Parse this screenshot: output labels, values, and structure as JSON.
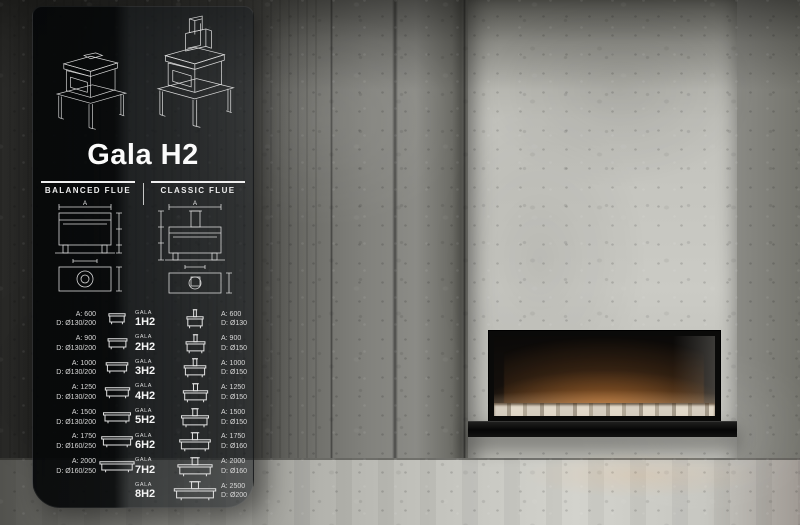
{
  "panel": {
    "title": "Gala H2",
    "balanced_header": "BALANCED FLUE",
    "classic_header": "CLASSIC FLUE",
    "diagram": {
      "width_label": "A"
    },
    "models": [
      {
        "series": "GALA",
        "name": "1H2",
        "balanced": {
          "a": "A: 600",
          "d": "D: Ø130/200"
        },
        "classic": {
          "a": "A: 600",
          "d": "D: Ø130"
        }
      },
      {
        "series": "GALA",
        "name": "2H2",
        "balanced": {
          "a": "A: 900",
          "d": "D: Ø130/200"
        },
        "classic": {
          "a": "A: 900",
          "d": "D: Ø150"
        }
      },
      {
        "series": "GALA",
        "name": "3H2",
        "balanced": {
          "a": "A: 1000",
          "d": "D: Ø130/200"
        },
        "classic": {
          "a": "A: 1000",
          "d": "D: Ø150"
        }
      },
      {
        "series": "GALA",
        "name": "4H2",
        "balanced": {
          "a": "A: 1250",
          "d": "D: Ø130/200"
        },
        "classic": {
          "a": "A: 1250",
          "d": "D: Ø150"
        }
      },
      {
        "series": "GALA",
        "name": "5H2",
        "balanced": {
          "a": "A: 1500",
          "d": "D: Ø130/200"
        },
        "classic": {
          "a": "A: 1500",
          "d": "D: Ø150"
        }
      },
      {
        "series": "GALA",
        "name": "6H2",
        "balanced": {
          "a": "A: 1750",
          "d": "D: Ø160/250"
        },
        "classic": {
          "a": "A: 1750",
          "d": "D: Ø160"
        }
      },
      {
        "series": "GALA",
        "name": "7H2",
        "balanced": {
          "a": "A: 2000",
          "d": "D: Ø160/250"
        },
        "classic": {
          "a": "A: 2000",
          "d": "D: Ø160"
        }
      },
      {
        "series": "GALA",
        "name": "8H2",
        "balanced": null,
        "classic": {
          "a": "A: 2500",
          "d": "D: Ø200"
        }
      }
    ],
    "icons": {
      "balanced_drawing": "balanced-flue-stove-drawing",
      "classic_drawing": "classic-flue-stove-drawing",
      "row_icon_balanced": "fireplace-front-icon",
      "row_icon_classic": "fireplace-front-flue-icon"
    }
  },
  "scene": {
    "description_items": [
      "concrete-room",
      "linear-gas-fireplace",
      "flames",
      "black-bench",
      "concrete-floor"
    ]
  },
  "colors": {
    "flame_core": "#fff6e8",
    "flame_mid": "#ffc87d",
    "flame_deep": "#f08a2c",
    "panel_glass_dark": "#06080a",
    "panel_text": "#e8e8e8",
    "concrete_light": "#cbcbc5",
    "concrete_dark": "#3c3c39"
  }
}
